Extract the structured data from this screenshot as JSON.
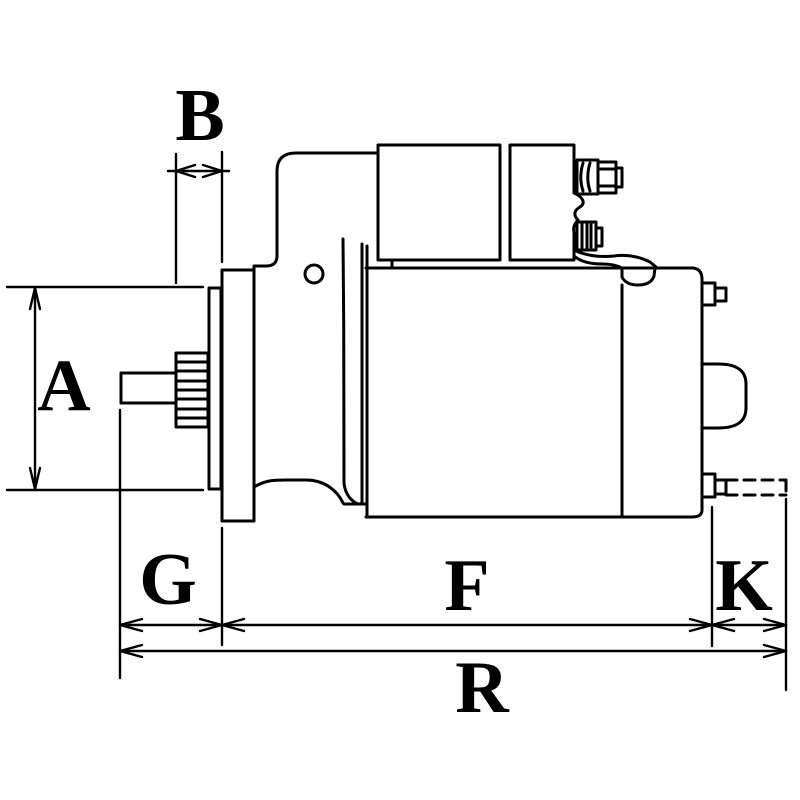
{
  "figure": {
    "background_color": "#ffffff",
    "line_color": "#000000",
    "labels": [
      {
        "id": "B",
        "text": "B"
      },
      {
        "id": "A",
        "text": "A"
      },
      {
        "id": "G",
        "text": "G"
      },
      {
        "id": "F",
        "text": "F"
      },
      {
        "id": "K",
        "text": "K"
      },
      {
        "id": "R",
        "text": "R"
      }
    ]
  }
}
